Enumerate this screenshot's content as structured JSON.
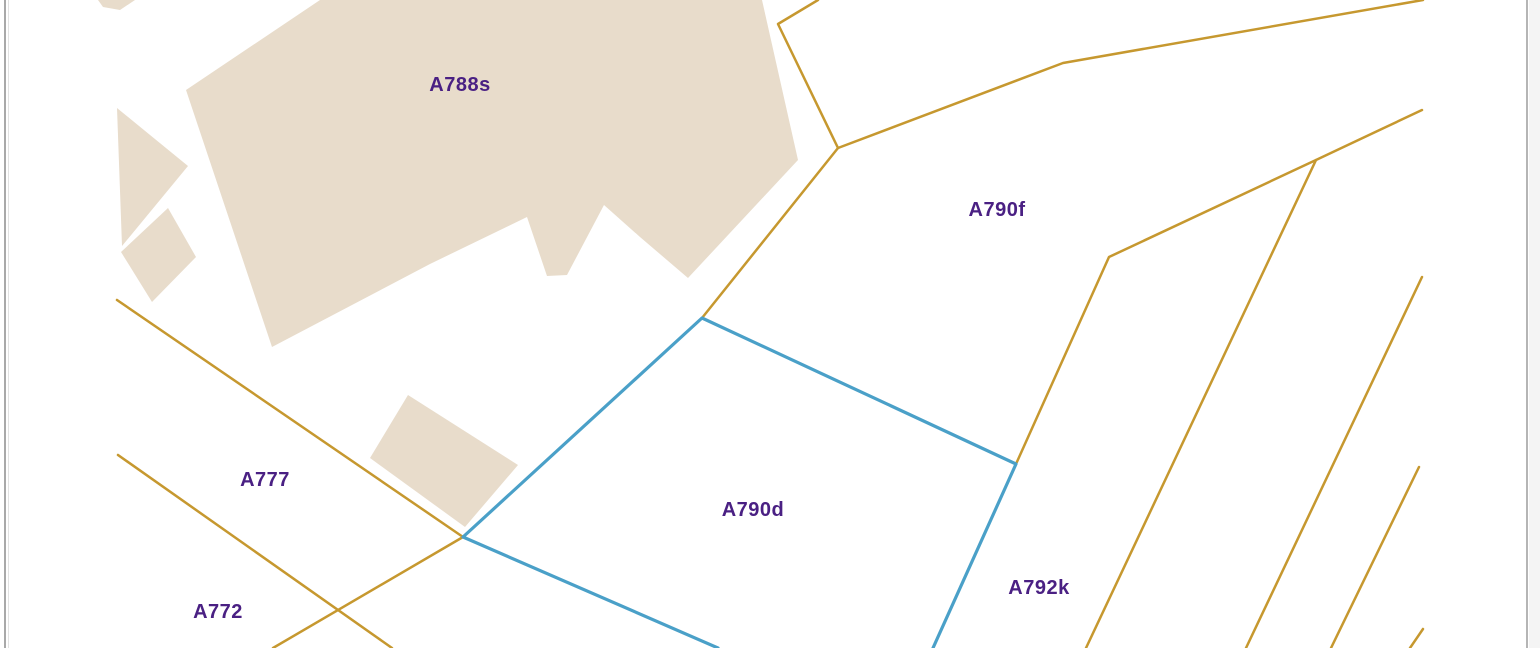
{
  "map": {
    "width": 1540,
    "height": 648,
    "background": "#ffffff",
    "colors": {
      "building_fill": "#e8dccb",
      "boundary_line": "#c6982f",
      "selected_outline": "#4aa0c8",
      "label_text": "#4a2083",
      "frame_dark": "#a9a9a9",
      "frame_light": "#e2e2e2",
      "frame_right": "#b5b5b5",
      "frame_margin": "#f4f4f4"
    },
    "frame": {
      "left_lines": [
        {
          "x": 4,
          "w": 2,
          "color": "#a9a9a9"
        },
        {
          "x": 8,
          "w": 1,
          "color": "#e2e2e2"
        }
      ],
      "right_lines": [
        {
          "x": 1526,
          "w": 2,
          "color": "#b5b5b5"
        },
        {
          "x": 1529,
          "w": 11,
          "color": "#f4f4f4"
        }
      ]
    },
    "buildings": [
      {
        "name": "building-a788s",
        "points": "186,90 320,0 762,0 798,160 688,278 640,237 604,205 567,275 547,276 527,217 430,264 272,347"
      },
      {
        "name": "building-small-top",
        "points": "98,0 135,0 120,10 103,7"
      },
      {
        "name": "building-small-1",
        "points": "117,108 188,166 122,246"
      },
      {
        "name": "building-small-2",
        "points": "168,208 196,257 152,302 121,252"
      },
      {
        "name": "building-small-3",
        "points": "408,395 518,465 465,527 370,458"
      }
    ],
    "boundary_lines": [
      {
        "points": "818,0 778,24 838,148"
      },
      {
        "points": "838,148 1063,63 1423,0"
      },
      {
        "points": "838,148 702,318"
      },
      {
        "points": "1422,110 1316,160 1109,257 1016,464"
      },
      {
        "points": "1316,160 1086,648"
      },
      {
        "points": "1422,277 1246,648"
      },
      {
        "points": "1419,467 1331,648"
      },
      {
        "points": "1423,629 1410,648"
      },
      {
        "points": "117,300 463,537"
      },
      {
        "points": "118,455 392,648"
      },
      {
        "points": "463,537 273,648"
      }
    ],
    "selected_parcel": {
      "label": "A790d",
      "points": "718,648 463,537 702,318 1016,464 933,648"
    },
    "parcel_labels": [
      {
        "text": "A788s",
        "cx": 460,
        "cy": 84
      },
      {
        "text": "A790f",
        "cx": 997,
        "cy": 209
      },
      {
        "text": "A790d",
        "cx": 753,
        "cy": 509
      },
      {
        "text": "A777",
        "cx": 265,
        "cy": 479
      },
      {
        "text": "A772",
        "cx": 218,
        "cy": 611
      },
      {
        "text": "A792k",
        "cx": 1039,
        "cy": 587
      }
    ]
  }
}
